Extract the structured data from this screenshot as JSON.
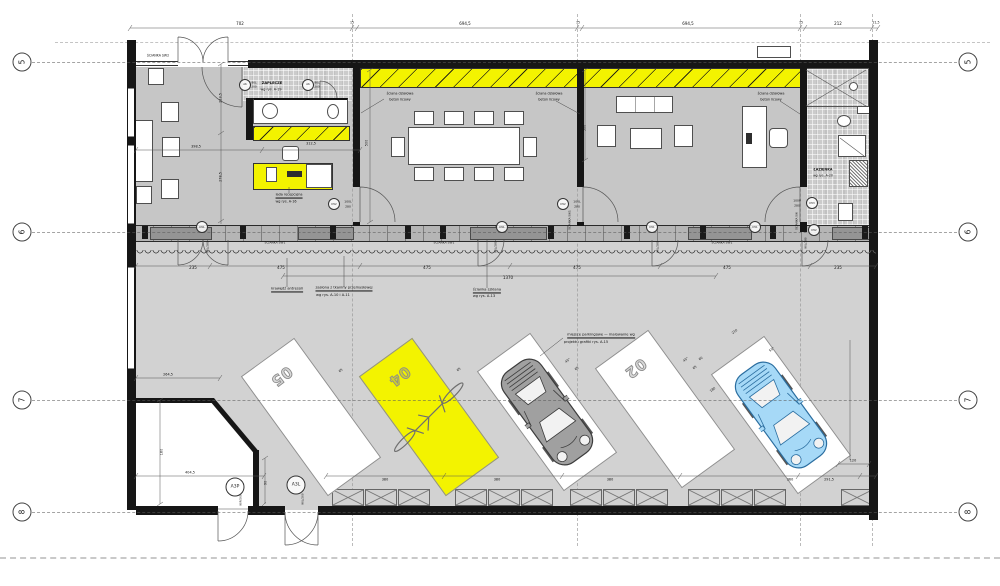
{
  "drawing": {
    "type": "architectural floor plan",
    "language": "Polish"
  },
  "colors": {
    "accent_yellow": "#f3f300",
    "wall_black": "#161616",
    "floor_office": "#c6c6c6",
    "floor_parking": "#d2d2d2",
    "car_blue": "#a6d9f7",
    "car_gray": "#a0a0a0"
  },
  "grid_markers": [
    {
      "label": "5",
      "y": 62
    },
    {
      "label": "6",
      "y": 232
    },
    {
      "label": "7",
      "y": 400
    },
    {
      "label": "8",
      "y": 512
    }
  ],
  "door_markers": [
    {
      "t": "A6",
      "x": 245,
      "y": 84.5
    },
    {
      "t": "A6",
      "x": 308,
      "y": 84.5
    },
    {
      "t": "D52",
      "x": 334,
      "y": 204
    },
    {
      "t": "D52",
      "x": 563,
      "y": 204
    },
    {
      "t": "D53",
      "x": 812,
      "y": 203
    },
    {
      "t": "D51",
      "x": 202,
      "y": 227
    },
    {
      "t": "D51",
      "x": 502,
      "y": 227
    },
    {
      "t": "D51",
      "x": 652,
      "y": 227
    },
    {
      "t": "D51",
      "x": 755,
      "y": 227
    },
    {
      "t": "D52",
      "x": 814,
      "y": 230
    },
    {
      "t": "A3P",
      "x": 235,
      "y": 487,
      "big": true
    },
    {
      "t": "A3L",
      "x": 296,
      "y": 485,
      "big": true
    }
  ],
  "parking": {
    "spaces": [
      {
        "num": "05",
        "x": 310,
        "y": 416,
        "fill": "white"
      },
      {
        "num": "04",
        "x": 428,
        "y": 416,
        "fill": "yellow",
        "bike": true
      },
      {
        "num": "",
        "x": 546,
        "y": 411,
        "fill": "white",
        "car": "gray"
      },
      {
        "num": "02",
        "x": 664,
        "y": 408,
        "fill": "white"
      },
      {
        "num": "",
        "x": 780,
        "y": 414,
        "fill": "white",
        "car": "blue"
      }
    ]
  },
  "annotations": [
    {
      "t": "702",
      "x": 240,
      "y": 24
    },
    {
      "t": "15",
      "x": 352,
      "y": 23,
      "fs": 3.2
    },
    {
      "t": "694,5",
      "x": 465,
      "y": 24
    },
    {
      "t": "15",
      "x": 578,
      "y": 23,
      "fs": 3.2
    },
    {
      "t": "694,5",
      "x": 688,
      "y": 24
    },
    {
      "t": "15",
      "x": 801,
      "y": 23,
      "fs": 3.2
    },
    {
      "t": "212",
      "x": 838,
      "y": 24
    },
    {
      "t": "21,5",
      "x": 876,
      "y": 23,
      "fs": 3.2
    },
    {
      "t": "ŚCIANKA SW2",
      "x": 158,
      "y": 56,
      "fs": 3.2
    },
    {
      "t": "ZAPLECZE",
      "x": 272,
      "y": 84,
      "fs": 3.6,
      "b": true
    },
    {
      "t": "wg rys. A-19",
      "x": 271,
      "y": 90,
      "fs": 3.4
    },
    {
      "t": "90L",
      "x": 254,
      "y": 83,
      "fs": 2.8
    },
    {
      "t": "200",
      "x": 254,
      "y": 87,
      "fs": 2.8
    },
    {
      "t": "90L",
      "x": 317,
      "y": 83,
      "fs": 2.8
    },
    {
      "t": "200",
      "x": 317,
      "y": 87,
      "fs": 2.8
    },
    {
      "t": "ściana działowa",
      "x": 400,
      "y": 94,
      "fs": 3.4
    },
    {
      "t": "beton licowy",
      "x": 400,
      "y": 99.5,
      "fs": 3.4
    },
    {
      "t": "ściana działowa",
      "x": 549,
      "y": 94,
      "fs": 3.4
    },
    {
      "t": "beton licowy",
      "x": 549,
      "y": 99.5,
      "fs": 3.4
    },
    {
      "t": "ściana działowa",
      "x": 771,
      "y": 94,
      "fs": 3.4
    },
    {
      "t": "beton licowy",
      "x": 771,
      "y": 99.5,
      "fs": 3.4
    },
    {
      "t": "398,5",
      "x": 196,
      "y": 147,
      "fs": 3.4
    },
    {
      "t": "312,5",
      "x": 311,
      "y": 144,
      "fs": 3.4
    },
    {
      "t": "223,5",
      "x": 221,
      "y": 98,
      "r": -90,
      "fs": 3.4
    },
    {
      "t": "278,5",
      "x": 221,
      "y": 177,
      "r": -90,
      "fs": 3.4
    },
    {
      "t": "500",
      "x": 367,
      "y": 143,
      "r": -90,
      "fs": 3.4
    },
    {
      "t": "500",
      "x": 585,
      "y": 128,
      "r": -90,
      "fs": 3.4
    },
    {
      "t": "lada recepcyjna",
      "x": 289,
      "y": 196,
      "fs": 3.4,
      "u": true
    },
    {
      "t": "wg rys. A-16",
      "x": 286,
      "y": 201.5,
      "fs": 3.4
    },
    {
      "t": "ŁAZIENKA",
      "x": 823,
      "y": 170,
      "fs": 3.4,
      "b": true
    },
    {
      "t": "wg rys. A-20",
      "x": 823,
      "y": 175.5,
      "fs": 3.2
    },
    {
      "t": "100L",
      "x": 348,
      "y": 201.5,
      "fs": 3
    },
    {
      "t": "280",
      "x": 348,
      "y": 206.5,
      "fs": 3
    },
    {
      "t": "100L",
      "x": 577,
      "y": 201.5,
      "fs": 3
    },
    {
      "t": "280",
      "x": 577,
      "y": 206.5,
      "fs": 3
    },
    {
      "t": "100P",
      "x": 797,
      "y": 200.5,
      "fs": 3
    },
    {
      "t": "280",
      "x": 797,
      "y": 205.5,
      "fs": 3
    },
    {
      "t": "ŚCIANKA SW1",
      "x": 275,
      "y": 243,
      "fs": 3
    },
    {
      "t": "ŚCIANKA SW1",
      "x": 444,
      "y": 243,
      "fs": 3
    },
    {
      "t": "ŚCIANKA SW1",
      "x": 722,
      "y": 243,
      "fs": 3
    },
    {
      "t": "ŚCIANKA SW1",
      "x": 570,
      "y": 220,
      "fs": 2.8,
      "r": -90
    },
    {
      "t": "ŚCIANKA SW",
      "x": 797,
      "y": 221,
      "fs": 2.8,
      "r": -90
    },
    {
      "t": "90L/280",
      "x": 208,
      "y": 247,
      "fs": 2.8,
      "r": -90
    },
    {
      "t": "90L/280",
      "x": 496,
      "y": 247,
      "fs": 2.8,
      "r": -90
    },
    {
      "t": "90L/280",
      "x": 658,
      "y": 247,
      "fs": 2.8,
      "r": -90
    },
    {
      "t": "90L/280",
      "x": 806,
      "y": 243,
      "fs": 2.8,
      "r": -90
    },
    {
      "t": "235",
      "x": 193,
      "y": 268
    },
    {
      "t": "475",
      "x": 281,
      "y": 268
    },
    {
      "t": "475",
      "x": 427,
      "y": 268
    },
    {
      "t": "475",
      "x": 577,
      "y": 268
    },
    {
      "t": "475",
      "x": 727,
      "y": 268
    },
    {
      "t": "235",
      "x": 838,
      "y": 268
    },
    {
      "t": "1370",
      "x": 508,
      "y": 278
    },
    {
      "t": "krawędź antresoli",
      "x": 287,
      "y": 290,
      "fs": 3.6,
      "u": true
    },
    {
      "t": "zasłona z tkaniny przemysłowej",
      "x": 344,
      "y": 289,
      "fs": 3.6,
      "u": true
    },
    {
      "t": "wg rys. A-10 i A-11",
      "x": 333,
      "y": 295.5,
      "fs": 3.6
    },
    {
      "t": "ścianka szklana",
      "x": 487,
      "y": 291,
      "fs": 3.6,
      "u": true
    },
    {
      "t": "wg rys. A-13",
      "x": 484,
      "y": 297,
      "fs": 3.6
    },
    {
      "t": "miejsce parkingowe — malowanie wg",
      "x": 601,
      "y": 336,
      "fs": 3.6,
      "u": true
    },
    {
      "t": "projektu grafiki rys. A-15",
      "x": 586,
      "y": 342.5,
      "fs": 3.6
    },
    {
      "t": "65",
      "x": 341,
      "y": 371,
      "fs": 3.2,
      "r": -36
    },
    {
      "t": "65",
      "x": 459,
      "y": 370,
      "fs": 3.2,
      "r": -36
    },
    {
      "t": "65",
      "x": 577,
      "y": 369,
      "fs": 3.2,
      "r": -36
    },
    {
      "t": "65",
      "x": 695,
      "y": 368,
      "fs": 3.2,
      "r": -36
    },
    {
      "t": "45°",
      "x": 568,
      "y": 361,
      "fs": 3.2,
      "r": -36
    },
    {
      "t": "45°",
      "x": 686,
      "y": 360,
      "fs": 3.2,
      "r": -36
    },
    {
      "t": "210",
      "x": 735,
      "y": 332,
      "fs": 3.2,
      "r": -36
    },
    {
      "t": "60",
      "x": 701,
      "y": 359,
      "fs": 3.2,
      "r": -36
    },
    {
      "t": "180",
      "x": 713,
      "y": 390,
      "fs": 3.2,
      "r": -36
    },
    {
      "t": "55°",
      "x": 772,
      "y": 350,
      "fs": 3.2,
      "r": -36
    },
    {
      "t": "264,5",
      "x": 168,
      "y": 375,
      "fs": 3.4
    },
    {
      "t": "180",
      "x": 162,
      "y": 452,
      "r": -90,
      "fs": 3.4
    },
    {
      "t": "90",
      "x": 266,
      "y": 483,
      "r": -90,
      "fs": 3.4
    },
    {
      "t": "404,5",
      "x": 190,
      "y": 473,
      "fs": 3.4
    },
    {
      "t": "90P/200",
      "x": 241,
      "y": 500,
      "fs": 2.8,
      "r": -90
    },
    {
      "t": "90L/200",
      "x": 303,
      "y": 499,
      "fs": 2.8,
      "r": -90
    },
    {
      "t": "380",
      "x": 385,
      "y": 480,
      "fs": 3.4
    },
    {
      "t": "380",
      "x": 497,
      "y": 480,
      "fs": 3.4
    },
    {
      "t": "380",
      "x": 610,
      "y": 480,
      "fs": 3.4
    },
    {
      "t": "360",
      "x": 790,
      "y": 480,
      "fs": 3.4
    },
    {
      "t": "291,5",
      "x": 829,
      "y": 480,
      "fs": 3.4
    },
    {
      "t": "120",
      "x": 853,
      "y": 461,
      "fs": 3.4
    }
  ]
}
